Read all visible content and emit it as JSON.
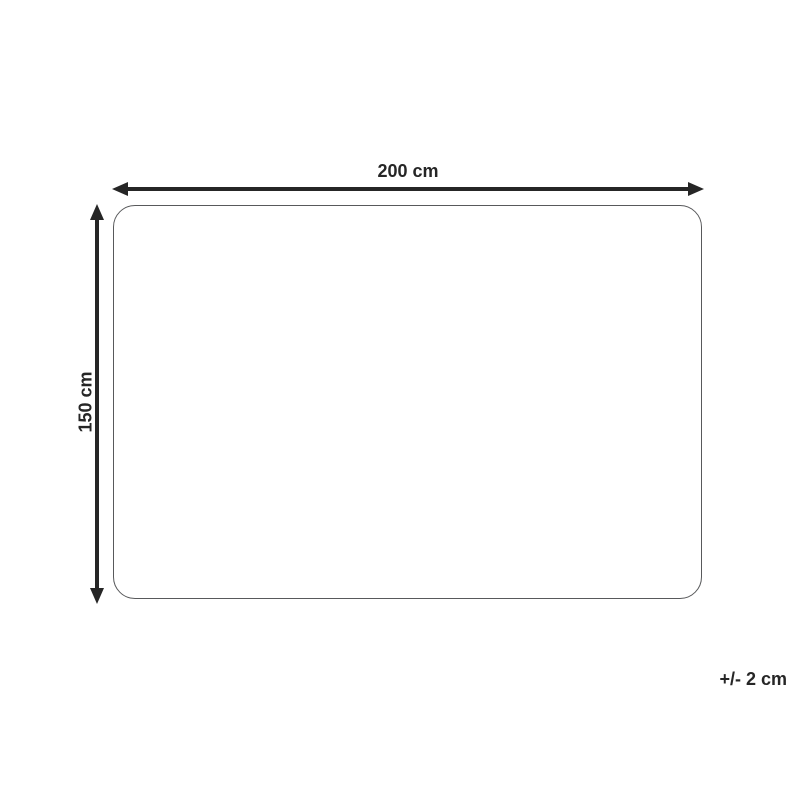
{
  "diagram": {
    "width_label": "200 cm",
    "height_label": "150 cm",
    "tolerance_label": "+/- 2 cm",
    "colors": {
      "arrow": "#262626",
      "label": "#262626",
      "outline": "#58595b",
      "background": "#ffffff"
    }
  }
}
